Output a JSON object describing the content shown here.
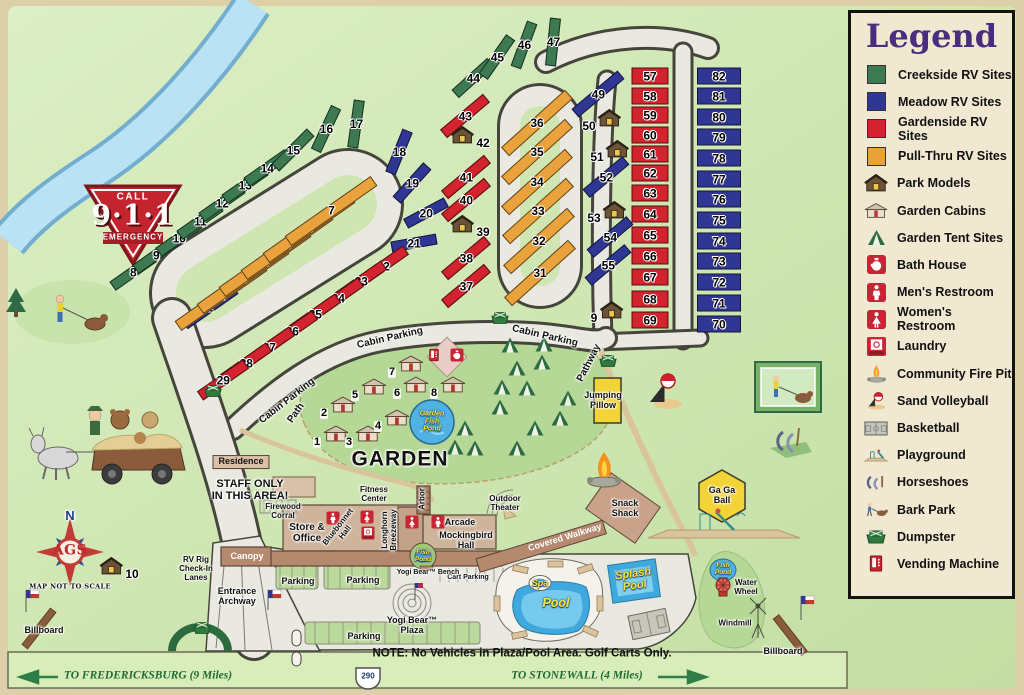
{
  "legend": {
    "title": "Legend",
    "items": [
      {
        "id": "creekside-rv-sites",
        "label": "Creekside RV Sites",
        "swatch": "#3d7a51"
      },
      {
        "id": "meadow-rv-sites",
        "label": "Meadow RV Sites",
        "swatch": "#2f3693"
      },
      {
        "id": "gardenside-rv-sites",
        "label": "Gardenside RV Sites",
        "swatch": "#d2232e"
      },
      {
        "id": "pull-thru-rv-sites",
        "label": "Pull-Thru RV Sites",
        "swatch": "#eaa33c"
      },
      {
        "id": "park-models",
        "label": "Park Models",
        "icon": "park-model"
      },
      {
        "id": "garden-cabins",
        "label": "Garden Cabins",
        "icon": "garden-cabin"
      },
      {
        "id": "garden-tent-sites",
        "label": "Garden Tent Sites",
        "icon": "tent"
      },
      {
        "id": "bath-house",
        "label": "Bath House",
        "icon": "bath"
      },
      {
        "id": "mens-restroom",
        "label": "Men's Restroom",
        "icon": "mens"
      },
      {
        "id": "womens-restroom",
        "label": "Women's Restroom",
        "icon": "womens"
      },
      {
        "id": "laundry",
        "label": "Laundry",
        "icon": "laundry"
      },
      {
        "id": "community-fire-pit",
        "label": "Community Fire Pit",
        "icon": "firepit"
      },
      {
        "id": "sand-volleyball",
        "label": "Sand Volleyball",
        "icon": "volleyball"
      },
      {
        "id": "basketball",
        "label": "Basketball",
        "icon": "basketball"
      },
      {
        "id": "playground",
        "label": "Playground",
        "icon": "playground"
      },
      {
        "id": "horseshoes",
        "label": "Horseshoes",
        "icon": "horseshoes"
      },
      {
        "id": "bark-park",
        "label": "Bark Park",
        "icon": "barkpark"
      },
      {
        "id": "dumpster",
        "label": "Dumpster",
        "icon": "dumpster"
      },
      {
        "id": "vending-machine",
        "label": "Vending Machine",
        "icon": "vending"
      }
    ]
  },
  "colors": {
    "creekside": "#3d7a51",
    "meadow": "#2f3693",
    "gardenside": "#d2232e",
    "pullthru": "#eaa33c"
  },
  "sites": {
    "creekside": [
      {
        "n": 8,
        "x": 133,
        "y": 272,
        "r": -35,
        "l": 50,
        "h": 11
      },
      {
        "n": 9,
        "x": 156,
        "y": 255,
        "r": -35,
        "l": 50,
        "h": 11
      },
      {
        "n": 10,
        "x": 179,
        "y": 238,
        "r": -35,
        "l": 50,
        "h": 11
      },
      {
        "n": 11,
        "x": 200,
        "y": 221,
        "r": -35,
        "l": 50,
        "h": 11
      },
      {
        "n": 12,
        "x": 222,
        "y": 203,
        "r": -35,
        "l": 50,
        "h": 11
      },
      {
        "n": 13,
        "x": 245,
        "y": 185,
        "r": -35,
        "l": 50,
        "h": 11
      },
      {
        "n": 14,
        "x": 267,
        "y": 168,
        "r": -35,
        "l": 50,
        "h": 11
      },
      {
        "n": 15,
        "x": 293,
        "y": 150,
        "r": -45,
        "l": 50,
        "h": 11
      },
      {
        "n": 16,
        "x": 326,
        "y": 129,
        "r": -65,
        "l": 48,
        "h": 11
      },
      {
        "n": 17,
        "x": 356,
        "y": 124,
        "r": -82,
        "l": 48,
        "h": 11
      },
      {
        "n": 44,
        "x": 473,
        "y": 78,
        "r": -42,
        "l": 48,
        "h": 11
      },
      {
        "n": 45,
        "x": 497,
        "y": 57,
        "r": -55,
        "l": 48,
        "h": 11
      },
      {
        "n": 46,
        "x": 524,
        "y": 45,
        "r": -70,
        "l": 48,
        "h": 11
      },
      {
        "n": 47,
        "x": 553,
        "y": 42,
        "r": -84,
        "l": 48,
        "h": 11
      }
    ],
    "meadow": [
      {
        "n": 1,
        "x": 210,
        "y": 307,
        "r": -35,
        "l": 62,
        "h": 11
      },
      {
        "n": 18,
        "x": 399,
        "y": 152,
        "r": -68,
        "l": 46,
        "h": 11
      },
      {
        "n": 19,
        "x": 412,
        "y": 183,
        "r": -48,
        "l": 46,
        "h": 11
      },
      {
        "n": 20,
        "x": 426,
        "y": 213,
        "r": -28,
        "l": 46,
        "h": 11
      },
      {
        "n": 21,
        "x": 414,
        "y": 243,
        "r": -10,
        "l": 46,
        "h": 11
      },
      {
        "n": 49,
        "x": 598,
        "y": 94,
        "r": -40,
        "l": 60,
        "h": 11
      },
      {
        "n": 52,
        "x": 606,
        "y": 177,
        "r": -40,
        "l": 52,
        "h": 11
      },
      {
        "n": 54,
        "x": 610,
        "y": 237,
        "r": -40,
        "l": 52,
        "h": 11
      },
      {
        "n": 55,
        "x": 608,
        "y": 265,
        "r": -40,
        "l": 52,
        "h": 11
      },
      {
        "n": 70,
        "x": 719,
        "y": 324,
        "r": 0,
        "l": 44,
        "h": 17
      },
      {
        "n": 71,
        "x": 719,
        "y": 303,
        "r": 0,
        "l": 44,
        "h": 17
      },
      {
        "n": 72,
        "x": 719,
        "y": 282,
        "r": 0,
        "l": 44,
        "h": 17
      },
      {
        "n": 73,
        "x": 719,
        "y": 261,
        "r": 0,
        "l": 44,
        "h": 17
      },
      {
        "n": 74,
        "x": 719,
        "y": 241,
        "r": 0,
        "l": 44,
        "h": 17
      },
      {
        "n": 75,
        "x": 719,
        "y": 220,
        "r": 0,
        "l": 44,
        "h": 17
      },
      {
        "n": 76,
        "x": 719,
        "y": 199,
        "r": 0,
        "l": 44,
        "h": 17
      },
      {
        "n": 77,
        "x": 719,
        "y": 179,
        "r": 0,
        "l": 44,
        "h": 17
      },
      {
        "n": 78,
        "x": 719,
        "y": 158,
        "r": 0,
        "l": 44,
        "h": 17
      },
      {
        "n": 79,
        "x": 719,
        "y": 137,
        "r": 0,
        "l": 44,
        "h": 17
      },
      {
        "n": 80,
        "x": 719,
        "y": 117,
        "r": 0,
        "l": 44,
        "h": 17
      },
      {
        "n": 81,
        "x": 719,
        "y": 96,
        "r": 0,
        "l": 44,
        "h": 17
      },
      {
        "n": 82,
        "x": 719,
        "y": 76,
        "r": 0,
        "l": 44,
        "h": 17
      }
    ],
    "gardenside": [
      {
        "n": 22,
        "x": 383,
        "y": 266,
        "r": -35,
        "l": 56,
        "h": 11
      },
      {
        "n": 23,
        "x": 361,
        "y": 281,
        "r": -35,
        "l": 56,
        "h": 11
      },
      {
        "n": 24,
        "x": 338,
        "y": 298,
        "r": -35,
        "l": 56,
        "h": 11
      },
      {
        "n": 25,
        "x": 315,
        "y": 314,
        "r": -35,
        "l": 56,
        "h": 11
      },
      {
        "n": 26,
        "x": 292,
        "y": 331,
        "r": -35,
        "l": 56,
        "h": 11
      },
      {
        "n": 27,
        "x": 269,
        "y": 347,
        "r": -35,
        "l": 56,
        "h": 11
      },
      {
        "n": 28,
        "x": 246,
        "y": 363,
        "r": -35,
        "l": 56,
        "h": 11
      },
      {
        "n": 29,
        "x": 223,
        "y": 380,
        "r": -35,
        "l": 56,
        "h": 11
      },
      {
        "n": 37,
        "x": 466,
        "y": 286,
        "r": -40,
        "l": 56,
        "h": 11
      },
      {
        "n": 38,
        "x": 466,
        "y": 258,
        "r": -40,
        "l": 56,
        "h": 11
      },
      {
        "n": 40,
        "x": 466,
        "y": 200,
        "r": -40,
        "l": 56,
        "h": 11
      },
      {
        "n": 41,
        "x": 466,
        "y": 177,
        "r": -40,
        "l": 56,
        "h": 11
      },
      {
        "n": 43,
        "x": 465,
        "y": 116,
        "r": -40,
        "l": 56,
        "h": 11
      },
      {
        "n": 57,
        "x": 650,
        "y": 76,
        "r": 0,
        "l": 37,
        "h": 17
      },
      {
        "n": 58,
        "x": 650,
        "y": 96,
        "r": 0,
        "l": 37,
        "h": 17
      },
      {
        "n": 59,
        "x": 650,
        "y": 115,
        "r": 0,
        "l": 37,
        "h": 17
      },
      {
        "n": 60,
        "x": 650,
        "y": 135,
        "r": 0,
        "l": 37,
        "h": 17
      },
      {
        "n": 61,
        "x": 650,
        "y": 154,
        "r": 0,
        "l": 37,
        "h": 17
      },
      {
        "n": 62,
        "x": 650,
        "y": 173,
        "r": 0,
        "l": 37,
        "h": 17
      },
      {
        "n": 63,
        "x": 650,
        "y": 193,
        "r": 0,
        "l": 37,
        "h": 17
      },
      {
        "n": 64,
        "x": 650,
        "y": 214,
        "r": 0,
        "l": 37,
        "h": 17
      },
      {
        "n": 65,
        "x": 650,
        "y": 235,
        "r": 0,
        "l": 37,
        "h": 17
      },
      {
        "n": 66,
        "x": 650,
        "y": 256,
        "r": 0,
        "l": 37,
        "h": 17
      },
      {
        "n": 67,
        "x": 650,
        "y": 277,
        "r": 0,
        "l": 37,
        "h": 17
      },
      {
        "n": 68,
        "x": 650,
        "y": 299,
        "r": 0,
        "l": 37,
        "h": 17
      },
      {
        "n": 69,
        "x": 650,
        "y": 320,
        "r": 0,
        "l": 37,
        "h": 17
      }
    ],
    "pullthru": [
      {
        "n": 2,
        "x": 221,
        "y": 296,
        "r": -35,
        "l": 105,
        "h": 12
      },
      {
        "n": 3,
        "x": 243,
        "y": 279,
        "r": -35,
        "l": 105,
        "h": 12
      },
      {
        "n": 4,
        "x": 265,
        "y": 262,
        "r": -35,
        "l": 105,
        "h": 12
      },
      {
        "n": 5,
        "x": 287,
        "y": 245,
        "r": -35,
        "l": 105,
        "h": 12
      },
      {
        "n": 6,
        "x": 309,
        "y": 228,
        "r": -35,
        "l": 105,
        "h": 12
      },
      {
        "n": 7,
        "x": 331,
        "y": 211,
        "r": -35,
        "l": 105,
        "h": 12
      },
      {
        "n": 31,
        "x": 540,
        "y": 273,
        "r": -42,
        "l": 86,
        "h": 12
      },
      {
        "n": 32,
        "x": 539,
        "y": 241,
        "r": -42,
        "l": 86,
        "h": 12
      },
      {
        "n": 33,
        "x": 538,
        "y": 211,
        "r": -42,
        "l": 86,
        "h": 12
      },
      {
        "n": 34,
        "x": 537,
        "y": 182,
        "r": -42,
        "l": 86,
        "h": 12
      },
      {
        "n": 35,
        "x": 537,
        "y": 152,
        "r": -42,
        "l": 86,
        "h": 12
      },
      {
        "n": 36,
        "x": 537,
        "y": 123,
        "r": -42,
        "l": 86,
        "h": 12
      }
    ]
  },
  "park_models": [
    {
      "n": 9,
      "x": 607,
      "y": 313,
      "side": "left"
    },
    {
      "n": 10,
      "x": 119,
      "y": 569,
      "side": "right"
    },
    {
      "n": 39,
      "x": 470,
      "y": 227,
      "side": "right"
    },
    {
      "n": 42,
      "x": 470,
      "y": 138,
      "side": "right"
    },
    {
      "n": 50,
      "x": 602,
      "y": 121,
      "side": "left"
    },
    {
      "n": 51,
      "x": 610,
      "y": 152,
      "side": "left"
    },
    {
      "n": 53,
      "x": 607,
      "y": 213,
      "side": "left"
    }
  ],
  "garden_cabins": [
    {
      "n": 1,
      "x": 331,
      "y": 436
    },
    {
      "n": 2,
      "x": 338,
      "y": 407
    },
    {
      "n": 3,
      "x": 363,
      "y": 436
    },
    {
      "n": 4,
      "x": 392,
      "y": 420
    },
    {
      "n": 5,
      "x": 369,
      "y": 389
    },
    {
      "n": 6,
      "x": 411,
      "y": 387
    },
    {
      "n": 7,
      "x": 406,
      "y": 366
    },
    {
      "n": 8,
      "x": 448,
      "y": 387
    }
  ],
  "tents": [
    [
      510,
      345
    ],
    [
      542,
      362
    ],
    [
      517,
      368
    ],
    [
      502,
      387
    ],
    [
      527,
      388
    ],
    [
      568,
      398
    ],
    [
      500,
      407
    ],
    [
      560,
      418
    ],
    [
      535,
      428
    ],
    [
      465,
      428
    ],
    [
      455,
      447
    ],
    [
      475,
      448
    ],
    [
      517,
      448
    ],
    [
      544,
      344
    ]
  ],
  "dumpsters": [
    [
      500,
      318
    ],
    [
      608,
      361
    ],
    [
      202,
      628
    ],
    [
      213,
      391
    ]
  ],
  "facilities": [
    {
      "k": "mens",
      "x": 333,
      "y": 518
    },
    {
      "k": "womens",
      "x": 367,
      "y": 517
    },
    {
      "k": "laundry",
      "x": 368,
      "y": 533
    },
    {
      "k": "womens",
      "x": 412,
      "y": 522
    },
    {
      "k": "mens",
      "x": 438,
      "y": 522
    },
    {
      "k": "bath",
      "x": 457,
      "y": 355
    },
    {
      "k": "vending",
      "x": 434,
      "y": 355
    }
  ],
  "labels": [
    {
      "t": "CALL",
      "x": 133,
      "y": 197,
      "cls": "b10"
    },
    {
      "t": "9·1·1",
      "x": 133,
      "y": 216,
      "cls": "nine"
    },
    {
      "t": "EMERGENCY",
      "x": 133,
      "y": 238,
      "cls": "b9"
    },
    {
      "t": "N",
      "x": 70,
      "y": 516,
      "cls": "north"
    },
    {
      "t": "AGS",
      "x": 70,
      "y": 551,
      "cls": "ags"
    },
    {
      "t": "MAP NOT TO SCALE",
      "x": 70,
      "y": 587,
      "cls": "scale"
    },
    {
      "t": "Billboard",
      "x": 44,
      "y": 631,
      "cls": "s9"
    },
    {
      "t": "Billboard",
      "x": 783,
      "y": 652,
      "cls": "s9"
    },
    {
      "t": "Cabin Parking",
      "x": 287,
      "y": 401,
      "r": -38,
      "cls": "road"
    },
    {
      "t": "Cabin Parking",
      "x": 390,
      "y": 338,
      "r": -13,
      "cls": "road"
    },
    {
      "t": "Cabin Parking",
      "x": 545,
      "y": 336,
      "r": 13,
      "cls": "road"
    },
    {
      "t": "Path",
      "x": 296,
      "y": 413,
      "r": -55,
      "cls": "road s8"
    },
    {
      "t": "Pathway",
      "x": 589,
      "y": 363,
      "r": -63,
      "cls": "road s8"
    },
    {
      "t": "GARDEN",
      "x": 400,
      "y": 459,
      "cls": "garden"
    },
    {
      "t": "Garden\nFish\nPond",
      "x": 432,
      "y": 422,
      "cls": "pond s7"
    },
    {
      "t": "Jumping\nPillow",
      "x": 603,
      "y": 401,
      "cls": "s9"
    },
    {
      "t": "Residence",
      "x": 241,
      "y": 462,
      "cls": "boxed"
    },
    {
      "t": "STAFF ONLY\nIN THIS AREA!",
      "x": 250,
      "y": 490,
      "cls": "staff"
    },
    {
      "t": "Firewood\nCorral",
      "x": 283,
      "y": 512,
      "cls": "s8"
    },
    {
      "t": "Store &\nOffice",
      "x": 307,
      "y": 533,
      "cls": "s10b"
    },
    {
      "t": "Bluebonnet\nHall",
      "x": 342,
      "y": 530,
      "r": -52,
      "cls": "s8"
    },
    {
      "t": "Fitness\nCenter",
      "x": 374,
      "y": 495,
      "cls": "s8"
    },
    {
      "t": "Longhorn\nBreezeway",
      "x": 390,
      "y": 530,
      "r": -90,
      "cls": "s8"
    },
    {
      "t": "Arbor",
      "x": 423,
      "y": 499,
      "r": -90,
      "cls": "s8"
    },
    {
      "t": "Arcade",
      "x": 460,
      "y": 523,
      "cls": "s9"
    },
    {
      "t": "Mockingbird\nHall",
      "x": 466,
      "y": 541,
      "cls": "s9"
    },
    {
      "t": "Fish\nPond",
      "x": 423,
      "y": 556,
      "cls": "pond s6"
    },
    {
      "t": "Canopy",
      "x": 247,
      "y": 557,
      "cls": "w s9"
    },
    {
      "t": "RV Rig\nCheck-In\nLanes",
      "x": 196,
      "y": 569,
      "cls": "s8"
    },
    {
      "t": "Entrance\nArchway",
      "x": 237,
      "y": 597,
      "cls": "s9"
    },
    {
      "t": "Parking",
      "x": 298,
      "y": 582,
      "cls": "s9"
    },
    {
      "t": "Parking",
      "x": 363,
      "y": 581,
      "cls": "s9"
    },
    {
      "t": "Parking",
      "x": 364,
      "y": 637,
      "cls": "s9"
    },
    {
      "t": "Cart Parking",
      "x": 468,
      "y": 578,
      "cls": "s7"
    },
    {
      "t": "Yogi Bear™ Bench",
      "x": 428,
      "y": 573,
      "cls": "s7"
    },
    {
      "t": "Yogi Bear™\nPlaza",
      "x": 412,
      "y": 626,
      "cls": "s9"
    },
    {
      "t": "Covered Walkway",
      "x": 565,
      "y": 538,
      "r": -17,
      "cls": "w s9"
    },
    {
      "t": "Snack\nShack",
      "x": 625,
      "y": 509,
      "cls": "s9"
    },
    {
      "t": "Outdoor\nTheater",
      "x": 505,
      "y": 504,
      "cls": "s8"
    },
    {
      "t": "Ga Ga\nBall",
      "x": 722,
      "y": 496,
      "cls": "s9"
    },
    {
      "t": "Spa",
      "x": 540,
      "y": 584,
      "cls": "pond s9"
    },
    {
      "t": "Pool",
      "x": 556,
      "y": 604,
      "cls": "pond s12"
    },
    {
      "t": "Splash\nPool",
      "x": 634,
      "y": 580,
      "r": -8,
      "cls": "pond s11"
    },
    {
      "t": "Fish\nPond",
      "x": 723,
      "y": 569,
      "cls": "pond s6"
    },
    {
      "t": "Water\nWheel",
      "x": 746,
      "y": 588,
      "cls": "s8"
    },
    {
      "t": "Windmill",
      "x": 735,
      "y": 624,
      "cls": "s8"
    },
    {
      "t": "NOTE: No Vehicles in Plaza/Pool Area. Golf Carts Only.",
      "x": 522,
      "y": 654,
      "cls": "note"
    },
    {
      "t": "TO FREDERICKSBURG (9 Miles)",
      "x": 148,
      "y": 676,
      "cls": "hwy"
    },
    {
      "t": "TO STONEWALL (4 Miles)",
      "x": 577,
      "y": 676,
      "cls": "hwy"
    },
    {
      "t": "290",
      "x": 368,
      "y": 677,
      "cls": "shield"
    }
  ]
}
